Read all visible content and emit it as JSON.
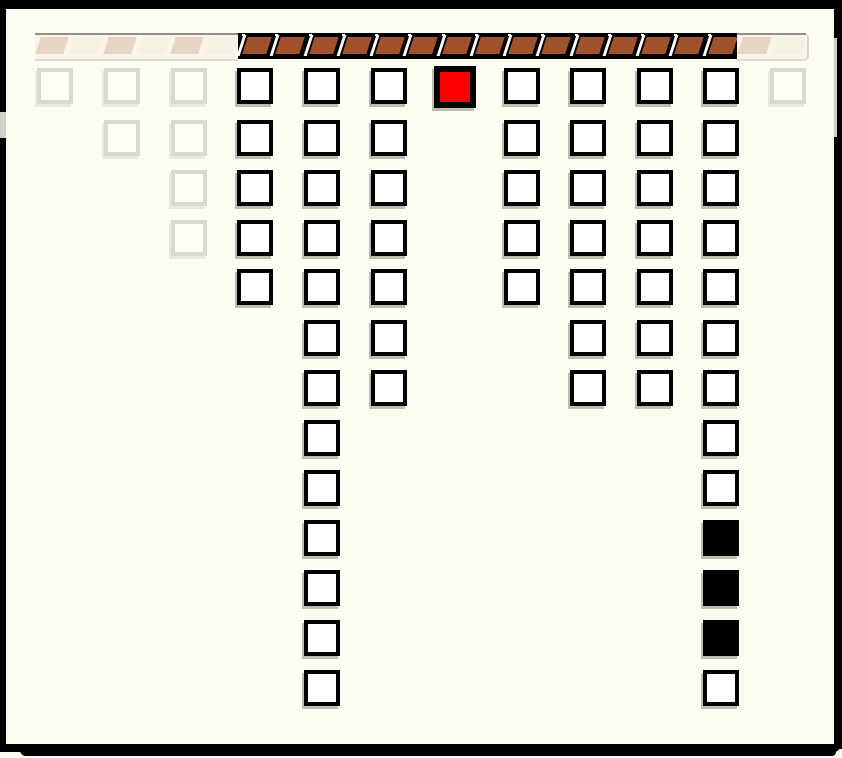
{
  "screen": {
    "width": 842,
    "height": 758,
    "background": "#fcfcf0",
    "frame_color": "#000000"
  },
  "brick_bar": {
    "top_line_color": "#161616",
    "segments": [
      {
        "name": "brick-bar-faded-left",
        "style": "faded",
        "x": 35,
        "width": 203,
        "brick_count": 6
      },
      {
        "name": "brick-bar-active",
        "style": "active",
        "x": 238,
        "width": 499,
        "brick_count": 15
      },
      {
        "name": "brick-bar-faded-right",
        "style": "faded",
        "x": 737,
        "width": 70,
        "brick_count": 2
      }
    ],
    "colors": {
      "active_brick": "#a0522d",
      "active_background": "#000000",
      "separator": "#ffffff",
      "faded_brick": "#e8d4c4",
      "faded_brick_alt": "#f6f1e2"
    }
  },
  "board": {
    "columns_x": [
      37,
      104,
      171,
      237,
      304,
      371,
      437,
      504,
      570,
      637,
      703,
      770
    ],
    "rows_y": [
      68,
      120,
      170,
      220,
      269,
      320,
      370,
      420,
      470,
      520,
      570,
      620,
      670
    ],
    "cell_states_by_column": [
      "G",
      "GG",
      "GGGG",
      "WWWWW",
      "WWWWWWWWWWWWW",
      "WWWWWWW",
      "R",
      "WWWWW",
      "WWWWWWW",
      "WWWWWWW",
      "WWWWWWWWWBBBW",
      "G"
    ],
    "legend": {
      "G": "ghost faded outline square",
      "W": "white outlined square",
      "B": "black filled square",
      "R": "red highlighted square"
    },
    "colors": {
      "outline": "#000000",
      "fill": "#ffffff",
      "ghost_outline": "#d9d9d0",
      "red": "#ff0000",
      "black": "#000000"
    }
  }
}
